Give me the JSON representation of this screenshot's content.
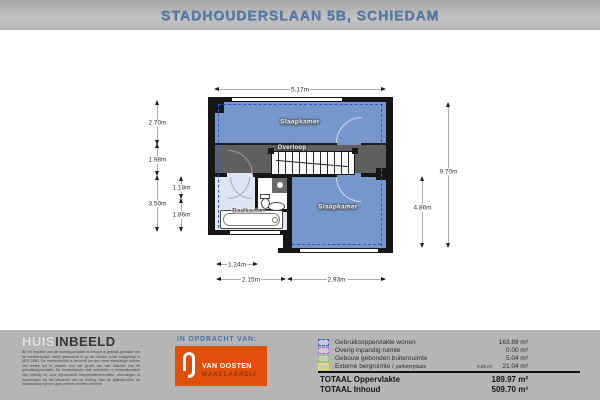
{
  "header": {
    "title": "STADHOUDERSLAAN 5B, SCHIEDAM"
  },
  "plan": {
    "rooms": {
      "bedroom_top": "Slaapkamer",
      "landing": "Overloop",
      "bathroom": "Badkamer",
      "bedroom_right": "Slaapkamer"
    },
    "dimensions": {
      "top": "5.17m",
      "left_outer": [
        "2.70m",
        "1.98m",
        "3.50m"
      ],
      "left_inner": [
        "1.18m",
        "1.86m"
      ],
      "right_outer": "9.70m",
      "right_inner": "4.86m",
      "bottom_row1": "1.24m",
      "bottom_row2": [
        "2.15m",
        "2.93m"
      ]
    }
  },
  "footer": {
    "brand": {
      "part1": "HUIS",
      "part2": "INBEELD",
      "disclaimer": "Bij het bepalen van de vloeroppervlakte en inhoud is gebruik gemaakt van de meetinstructie, welke gebaseerd is op de normen zoals vastgelegd in NEN 2580. De meetinstructie is bedoeld om een meer eenduidige manier van meten toe te passen voor het geven van een indicatie van de gebruiksoppervlakte. De meetinstructie sluit verschillen in meetuitkomsten niet volledig uit, door bijvoorbeeld interpretatieverschillen, afrondingen of beperkingen bij het uitvoeren van de meting. Aan de plattegronden en maatvoering kunnen geen rechten worden ontleend."
    },
    "client": {
      "heading": "IN OPDRACHT VAN:",
      "logo_line1": "VAN OOSTEN",
      "logo_line2": "MAKELAARDIJ"
    },
    "legend": {
      "rows": [
        {
          "label": "Gebruiksoppervlakte wonen",
          "value": "163.89 m²",
          "color": "#3b5bd6"
        },
        {
          "label": "Overig inpandig ruimte",
          "value": "0.00 m²",
          "color": "#b06bd4"
        },
        {
          "label": "Gebouw gebonden buitenruimte",
          "value": "5.04 m²",
          "color": "#7dc855"
        },
        {
          "label": "Externe bergruimte /",
          "label_small": "parkeerplaats",
          "extra": "0.00 m²",
          "value": "21.04 m²",
          "color": "#e8e23a"
        }
      ],
      "totals": [
        {
          "label": "TOTAAL Oppervlakte",
          "value": "189.97 m²"
        },
        {
          "label": "TOTAAL Inhoud",
          "value": "509.70 m³"
        }
      ]
    }
  },
  "colors": {
    "header_text": "#5b7da9",
    "room_blue": "#7697c9",
    "bathroom_blue": "#dde6f0",
    "landing_gray": "#5f5f5f",
    "wall_black": "#161616",
    "measure_dash_blue": "#2b55d8",
    "client_orange": "#e1500b"
  }
}
